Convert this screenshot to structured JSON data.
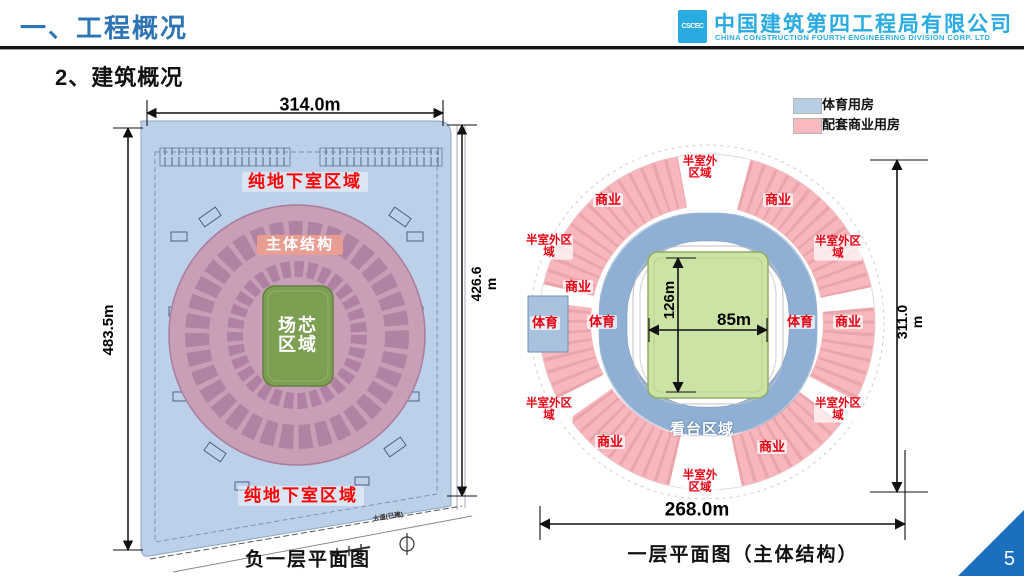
{
  "slide": {
    "title": "一、工程概况",
    "subtitle": "2、建筑概况",
    "page_number": "5"
  },
  "logo": {
    "mark": "CSCEC",
    "company_cn": "中国建筑第四工程局有限公司",
    "company_en": "CHINA CONSTRUCTION FOURTH ENGINEERING DIVISION CORP. LTD"
  },
  "colors": {
    "accent_blue": "#2E75B6",
    "logo_cyan": "#29ABE2",
    "basement_blue": "#BDD0EA",
    "structure_mauve": "#C89FB7",
    "core_green": "#7C9F52",
    "sports_room_blue": "#B9CDE5",
    "commercial_pink": "#F7B7BC",
    "stand_ring_blue": "#8FAFD4",
    "field_green": "#CBE3A4",
    "label_red": "#E60012",
    "page_corner_blue": "#1B6FBE"
  },
  "left_diagram": {
    "caption": "负一层平面图",
    "dims": {
      "top": "314.0m",
      "left": "483.5m",
      "right": "426.6\nm"
    },
    "labels": {
      "basement_top": "纯地下室区域",
      "basement_bottom": "纯地下室区域",
      "main_structure": "主体结构",
      "core_area": "场芯\n区域",
      "road": "大道(已建)"
    }
  },
  "right_diagram": {
    "caption": "一层平面图（主体结构）",
    "dims": {
      "bottom": "268.0m",
      "right": "311.0\nm",
      "field_width": "85m",
      "field_height": "126m"
    },
    "legend": [
      {
        "label": "体育用房"
      },
      {
        "label": "配套商业用房"
      }
    ],
    "labels": {
      "semi_outdoor_top": "半室外\n区域",
      "commercial_upper_left": "商业",
      "commercial_upper_right": "商业",
      "semi_outdoor_left": "半室外区\n域",
      "semi_outdoor_right": "半室外区\n域",
      "commercial_left": "商业",
      "sports_far_left": "体育",
      "sports_left": "体育",
      "sports_right": "体育",
      "commercial_far_right": "商业",
      "semi_outdoor_lower_left": "半室外区\n域",
      "semi_outdoor_lower_right": "半室外区\n域",
      "commercial_lower_left": "商业",
      "commercial_lower_right": "商业",
      "semi_outdoor_bottom": "半室外\n区域",
      "stand_area": "看台区域"
    }
  }
}
